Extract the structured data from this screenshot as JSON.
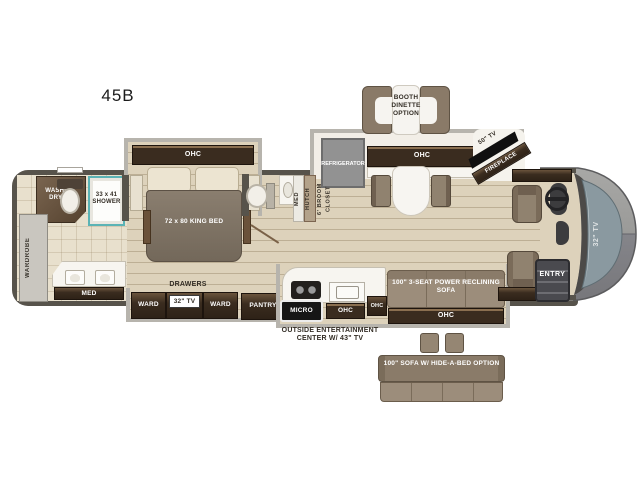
{
  "model": "45B",
  "colors": {
    "wall": "#57534b",
    "floor": "#ddd2bb",
    "bath_floor": "#e8e0cd",
    "dark_wood": "#3a2c1f",
    "furniture_brown": "#90826f",
    "slide_border": "#b7b4ad",
    "shower_trim": "#5bb3b5",
    "windshield": "#8a99a0",
    "refrigerator_gray": "#929292"
  },
  "bedroom": {
    "ohc": "OHC",
    "king_bed": "72 x 80 KING BED",
    "drawers": "DRAWERS",
    "ward_left": "WARD",
    "tv": "32\" TV",
    "ward_right": "WARD",
    "pantry": "PANTRY"
  },
  "rear_bath": {
    "washer_dryer": "WASHER/ DRYER",
    "shower": "33 x 41 SHOWER",
    "wardrobe": "WARDROBE",
    "med": "MED"
  },
  "mid_bath": {
    "med": "MED",
    "hutch": "HUTCH",
    "broom_closet": "6' BROOM CLOSET"
  },
  "galley": {
    "refrigerator": "REFRIGERATOR",
    "ohc": "OHC",
    "tv": "50\" TV",
    "fireplace": "FIREPLACE",
    "micro": "MICRO",
    "ohc_sink": "OHC",
    "ohc_side": "OHC",
    "outside_entertainment": "OUTSIDE ENTERTAINMENT CENTER W/ 43\" TV"
  },
  "living": {
    "sofa": "100\" 3-SEAT POWER RECLINING SOFA",
    "sofa_ohc": "OHC"
  },
  "front": {
    "entry": "ENTRY",
    "tv": "32\" TV"
  },
  "options": {
    "booth_dinette": "BOOTH DINETTE OPTION",
    "hide_a_bed": "100\" SOFA W/ HIDE-A-BED OPTION"
  }
}
